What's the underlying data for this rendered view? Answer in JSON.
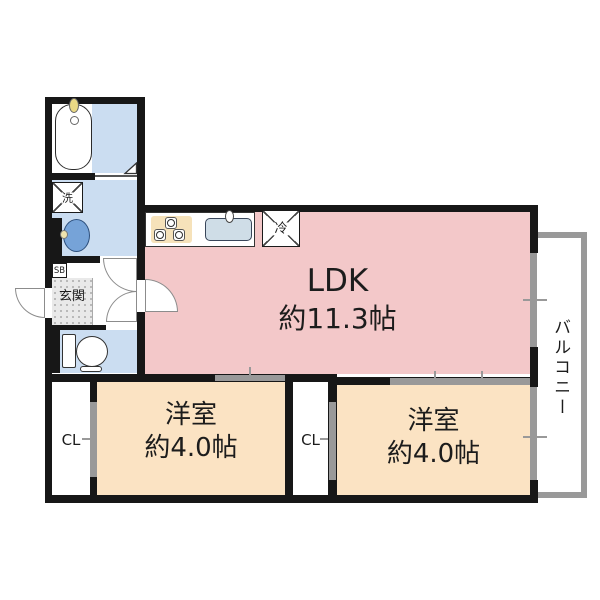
{
  "plan": {
    "type": "apartment-floor-plan",
    "rooms": {
      "ldk": {
        "name": "LDK",
        "size": "約11.3帖"
      },
      "bedroom_left": {
        "name": "洋室",
        "size": "約4.0帖"
      },
      "bedroom_right": {
        "name": "洋室",
        "size": "約4.0帖"
      },
      "balcony": {
        "name": "バルコニー"
      },
      "entrance": {
        "name": "玄関"
      },
      "closet_left": {
        "name": "CL"
      },
      "closet_middle": {
        "name": "CL"
      }
    },
    "fixtures": {
      "washer_place": {
        "label": "洗"
      },
      "fridge_place": {
        "label": "冷"
      },
      "shoe_box": {
        "label": "SB"
      }
    },
    "colors": {
      "ldk_pink": "#f3c8c9",
      "bedroom_peach": "#fbe3c3",
      "wet_area_blue": "#cbddf1",
      "wall_black": "#171717",
      "fitting_gray": "#999999",
      "entrance_floor": "#e9e9e9"
    }
  }
}
